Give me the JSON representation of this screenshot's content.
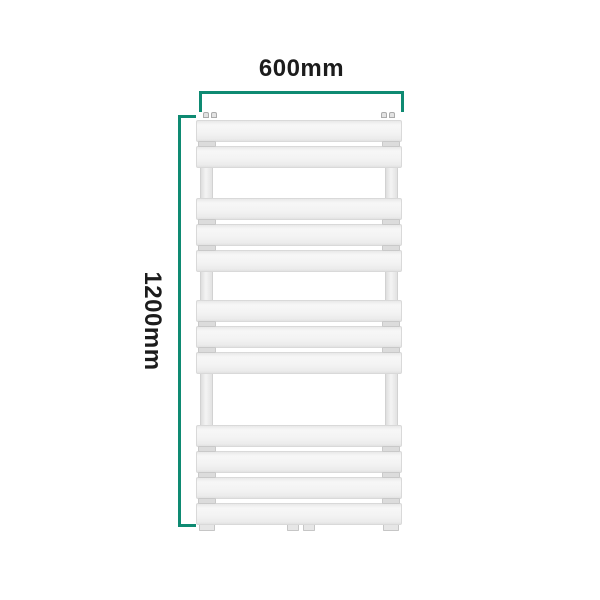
{
  "diagram": {
    "width_label": "600mm",
    "height_label": "1200mm",
    "radiator": {
      "product": "flat-panel-heated-towel-rail",
      "panel_groups": [
        2,
        3,
        3,
        4
      ],
      "panel_total": 12
    },
    "colors": {
      "dimension_line": "#0e8a72",
      "label_text": "#1c1c1c",
      "panel_fill": "#f3f3f3",
      "panel_edge": "#d9d9d9",
      "background": "#ffffff"
    }
  }
}
